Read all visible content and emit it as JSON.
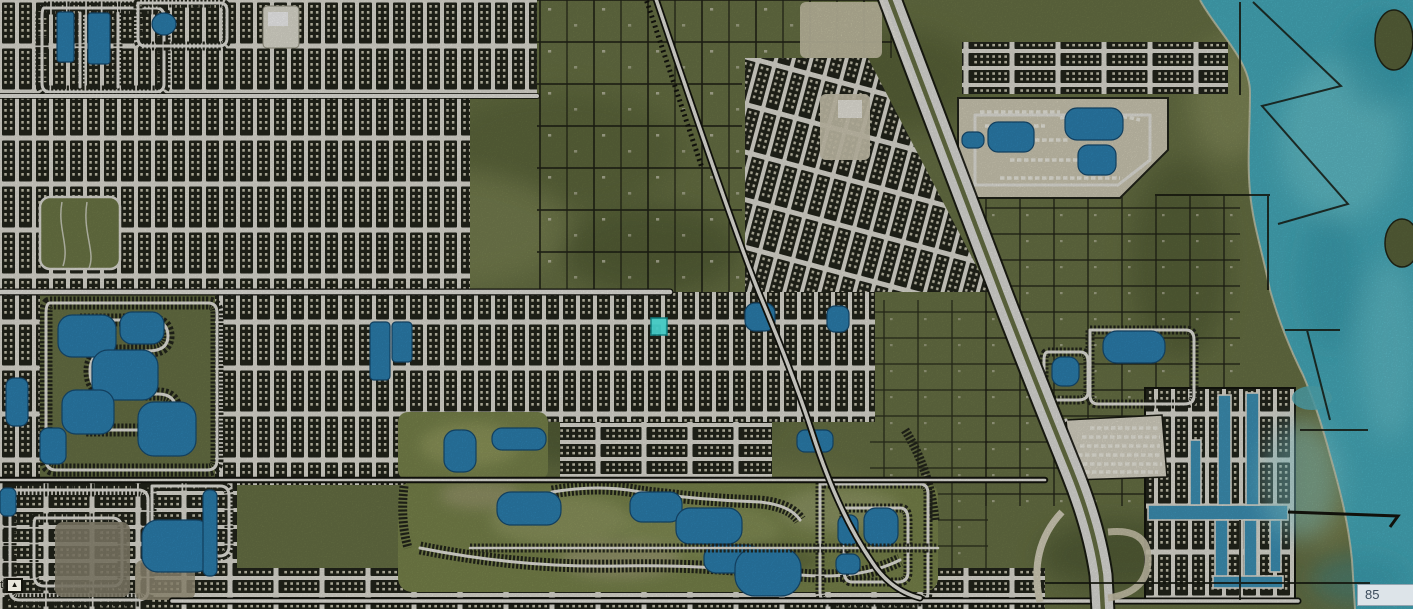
{
  "map": {
    "corner_label": "85",
    "scale_unit_label": "ft",
    "north_arrow_glyph": "▲",
    "features": [
      "lagoon-water",
      "coastline",
      "barrier-islands",
      "divided-highway",
      "diagonal-road",
      "railroad",
      "dense-residential-grid",
      "rural-parcel-grid",
      "golf-course",
      "lakes-and-ponds",
      "canal-community",
      "construction-site",
      "waterfront-community",
      "selected-parcel"
    ]
  },
  "colors": {
    "land_base": "#6d7748",
    "land_dark": "#50592f",
    "land_light": "#8a9158",
    "water_lagoon": "#4ab3c4",
    "water_light": "#7ed8de",
    "lake_blue": "#2e86b8",
    "canal_blue": "#4098be",
    "road_white": "#efeee6",
    "parcel_line": "#181a10",
    "dense_block": "#24261c",
    "rooftop": "#cfccb6",
    "bare_earth": "#e3dfcf",
    "dirt": "#8f8a74",
    "highlight_parcel": "#45cbc6",
    "label_bg": "#dde4e9",
    "label_border": "#93a5b0",
    "label_text": "#3c4c5c"
  }
}
